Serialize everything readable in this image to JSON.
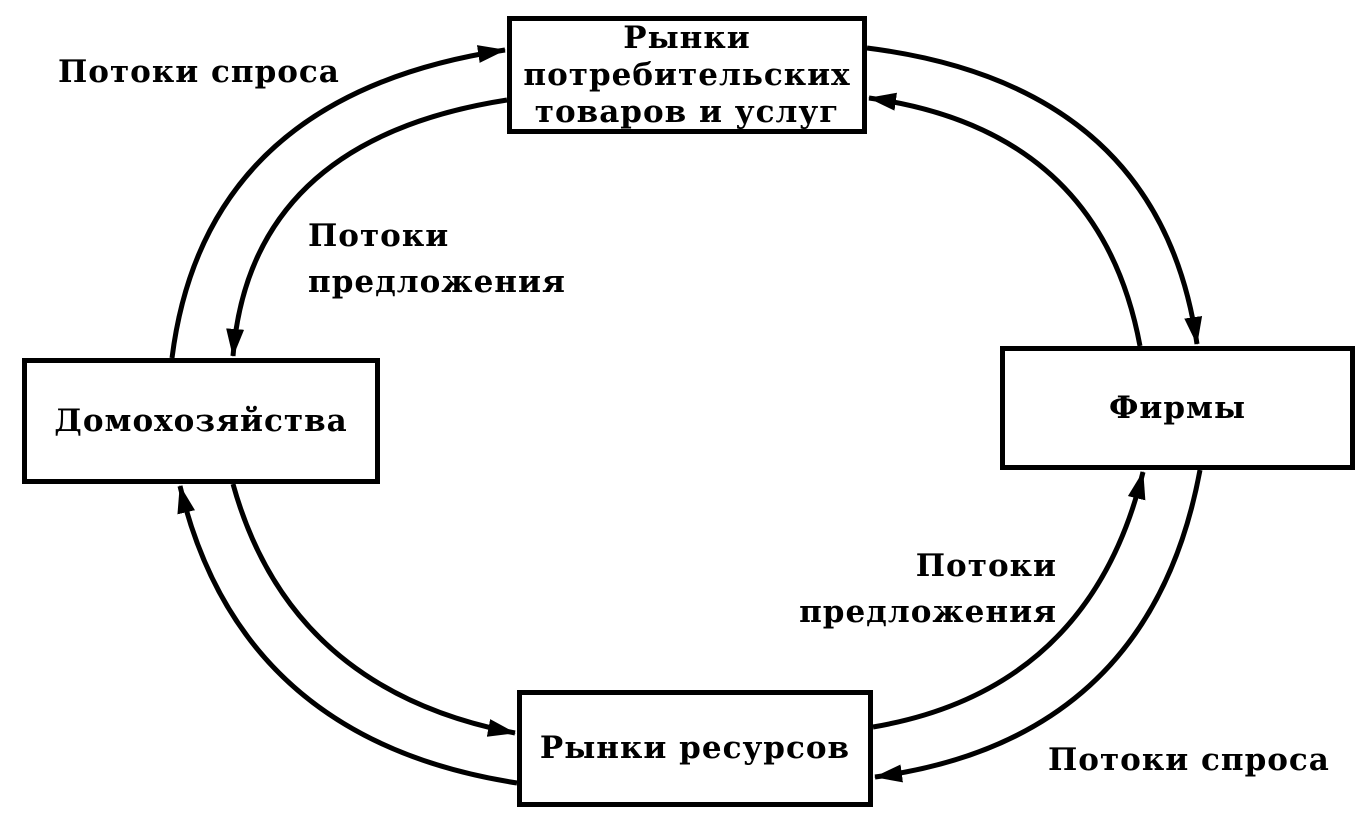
{
  "diagram": {
    "description": "Circular flow diagram of demand and supply flows between households, firms and markets",
    "colors": {
      "ink": "#000000",
      "background": "#ffffff"
    },
    "nodes": {
      "consumer_markets": {
        "label": "Рынки\nпотребительских\nтоваров и услуг"
      },
      "households": {
        "label": "Домохозяйства"
      },
      "firms": {
        "label": "Фирмы"
      },
      "resource_markets": {
        "label": "Рынки ресурсов"
      }
    },
    "flow_labels": {
      "demand_top_left": "Потоки спроса",
      "supply_top_left": "Потоки\nпредложения",
      "supply_bottom_right": "Потоки\nпредложения",
      "demand_bottom_right": "Потоки спроса"
    }
  }
}
